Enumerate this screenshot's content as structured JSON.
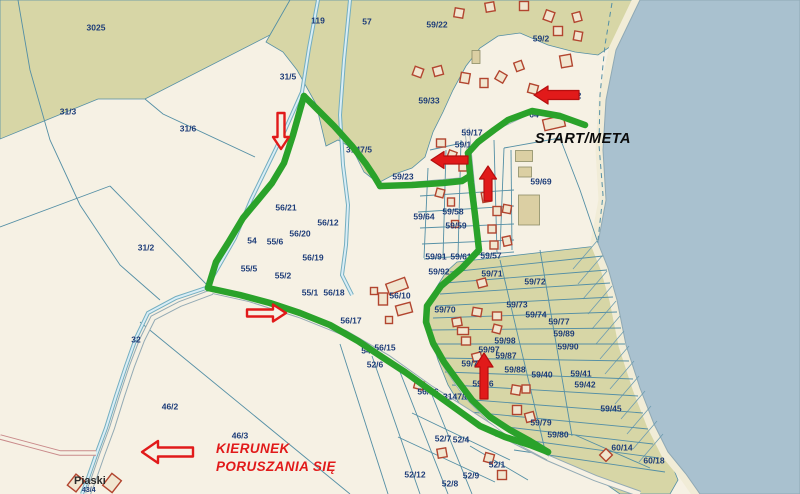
{
  "map": {
    "width": 800,
    "height": 494,
    "colors": {
      "land": "#f6f1e4",
      "forest": "#d7d6a6",
      "water": "#a9c1cf",
      "beach": "#f1ecd7",
      "boundary": "#548fa5",
      "route": "#2aa22a",
      "arrow": "#e11a1a",
      "arrow_dark": "#b50f0f",
      "label": "#1d3c78",
      "building_outline": "#b2452f",
      "building_fill": "#f1e6d0",
      "tan_fill": "#dbcfa3",
      "tan_outline": "#8c8c66",
      "road_edge": "#93aab4",
      "road_fill": "#f6f1e4",
      "stream_edge": "#74aebf",
      "stream_fill": "#d9edf6",
      "pink_road": "#c98a8a",
      "hatch": "#6d9cb0",
      "shore_edge": "#8fa9b5"
    },
    "texts": {
      "start_meta": "START/META",
      "kierunek_line1": "KIERUNEK",
      "kierunek_line2": "PORUSZANIA SIĘ",
      "place": "Piaski",
      "place_sub": "43/4"
    },
    "areas": [
      {
        "n": "forest-area-3025",
        "p": "0,0 290,0 270,35 145,99 98,99 0,139"
      },
      {
        "n": "forest-area-north",
        "p": "290,0 640,0 617,42 598,55 575,52 548,45 520,33 498,36 480,48 466,66 453,90 443,112 433,132 425,157 412,168 395,174 378,183 364,172 352,148 338,140 326,146 316,104 297,70 283,52 266,42"
      },
      {
        "n": "forest-area-southeast",
        "p": "457,262 597,246 608,268 617,300 626,345 640,388 654,424 668,455 678,480 670,494 620,494 600,480 560,462 530,447 505,436 480,425 462,408 448,385 438,360 430,335 428,308 436,288 446,272"
      }
    ],
    "beach": "640,0 616,50 606,100 603,150 606,200 598,243 608,268 617,300 626,345 640,388 654,424 668,452 686,474 700,494",
    "water": "640,0 800,0 800,494 700,494 686,474 668,452 654,424 640,388 626,345 617,300 608,268 598,243 606,200 603,150 606,100 616,50",
    "hatch_centers": [
      [
        585,
        255
      ],
      [
        590,
        270
      ],
      [
        595,
        285
      ],
      [
        600,
        300
      ],
      [
        604,
        315
      ],
      [
        608,
        330
      ],
      [
        612,
        345
      ],
      [
        617,
        360
      ],
      [
        622,
        375
      ],
      [
        627,
        390
      ],
      [
        633,
        405
      ],
      [
        639,
        420
      ],
      [
        645,
        435
      ],
      [
        651,
        448
      ]
    ],
    "streams": [
      {
        "p": "318,0 309,48 302,92 285,130 268,165 251,200 235,238 219,266 206,288 176,298 148,313 136,338 126,366 116,396 106,428 96,455 88,478 82,494"
      },
      {
        "p": "350,0 344,60 340,115 343,165 348,205 346,245 342,275 352,295"
      }
    ],
    "roads": [
      {
        "p": "205,289 250,299 300,315 345,333 388,358 430,388 468,412 505,436 548,458 595,478 640,494",
        "ow": 6.5,
        "iw": 4.5,
        "pink": false
      },
      {
        "p": "212,292 180,304 153,318 142,340 132,366 122,396 112,428 102,455 94,478 88,494",
        "ow": 6,
        "iw": 4,
        "pink": false
      },
      {
        "p": "96,453 60,453 30,445 0,437",
        "ow": 5.5,
        "iw": 3.5,
        "pink": true
      },
      {
        "p": "467,128 471,170 475,210 479,250 462,268 440,287 427,307 426,322 433,345 448,370 466,396 490,420 520,443 548,458",
        "ow": 5,
        "iw": 3.5,
        "pink": false
      },
      {
        "p": "378,187 468,179",
        "ow": 4.5,
        "iw": 3,
        "pink": false
      },
      {
        "p": "468,152 496,128 530,112 560,117 585,125",
        "ow": 4.5,
        "iw": 3,
        "pink": false
      }
    ],
    "lines": [
      {
        "p": "110,186 208,286"
      },
      {
        "p": "0,227 110,186"
      },
      {
        "p": "145,99 163,114 255,157"
      },
      {
        "p": "140,322 350,494"
      },
      {
        "p": "340,344 388,494"
      },
      {
        "p": "372,356 420,494"
      },
      {
        "p": "400,372 448,494"
      },
      {
        "p": "432,395 472,494"
      },
      {
        "p": "412,413 510,460"
      },
      {
        "p": "398,437 495,482"
      },
      {
        "p": "470,446 528,480"
      },
      {
        "p": "575,435 650,468"
      },
      {
        "p": "428,168 424,258"
      },
      {
        "p": "446,150 443,258"
      },
      {
        "p": "461,140 458,256"
      },
      {
        "p": "494,140 497,253"
      },
      {
        "p": "511,150 512,250"
      },
      {
        "p": "420,196 514,190"
      },
      {
        "p": "418,212 514,206"
      },
      {
        "p": "420,228 514,224"
      },
      {
        "p": "422,244 514,240"
      },
      {
        "p": "424,259 514,252"
      },
      {
        "p": "430,150 462,143"
      },
      {
        "p": "504,148 500,250"
      },
      {
        "p": "504,148 560,138"
      },
      {
        "p": "560,138 580,190 598,243"
      },
      {
        "p": "450,272 603,256"
      },
      {
        "p": "445,283 607,270"
      },
      {
        "p": "440,294 610,283"
      },
      {
        "p": "436,306 613,297"
      },
      {
        "p": "433,318 617,312"
      },
      {
        "p": "430,330 621,328"
      },
      {
        "p": "432,344 625,344"
      },
      {
        "p": "438,358 629,361"
      },
      {
        "p": "445,372 633,379"
      },
      {
        "p": "452,385 638,396"
      },
      {
        "p": "461,399 643,413"
      },
      {
        "p": "470,412 648,429"
      },
      {
        "p": "481,424 653,444"
      },
      {
        "p": "495,436 659,458"
      },
      {
        "p": "514,450 665,472"
      },
      {
        "p": "500,260 545,450"
      },
      {
        "p": "540,250 572,436"
      },
      {
        "p": "18,0 30,70 50,140 80,205 120,265 160,300"
      }
    ],
    "dashed": [
      {
        "p": "612,3 605,45 600,95 599,145 603,195 598,240"
      }
    ],
    "route_segments": [
      "585,125 560,116 532,111 508,120 494,130 478,142 468,153",
      "468,153 471,183 475,215 479,250 462,268 441,286 427,306 426,322 433,343 444,362 457,380 472,400 490,417 510,430 530,441 548,452",
      "548,452 530,445 505,437 480,426 455,408 430,390 405,372 382,357 358,341 330,325 300,313 270,303 240,295 208,288",
      "208,288 216,262 228,243 243,218 258,200 272,183 284,163 293,135 300,110 304,96",
      "304,96 318,110 334,126 352,146 366,164 374,176 380,186",
      "380,186 412,185 443,183 462,181 470,176"
    ],
    "arrows": [
      {
        "tx": 281,
        "ty": 113,
        "px": 281,
        "py": 149,
        "s": 3.5,
        "h": 8,
        "hl": 12,
        "style": "hollow"
      },
      {
        "tx": 468,
        "ty": 160,
        "px": 431,
        "py": 160,
        "s": 4,
        "h": 8.5,
        "hl": 13,
        "style": "solid"
      },
      {
        "tx": 488,
        "ty": 201,
        "px": 488,
        "py": 166,
        "s": 4,
        "h": 8.5,
        "hl": 13,
        "style": "solid"
      },
      {
        "tx": 247,
        "ty": 313,
        "px": 286,
        "py": 313,
        "s": 3.5,
        "h": 8.5,
        "hl": 13,
        "style": "hollow"
      },
      {
        "tx": 484,
        "ty": 399,
        "px": 484,
        "py": 353,
        "s": 4,
        "h": 9,
        "hl": 14,
        "style": "solid"
      },
      {
        "tx": 579,
        "ty": 95,
        "px": 534,
        "py": 95,
        "s": 4.5,
        "h": 9,
        "hl": 14,
        "style": "solid"
      },
      {
        "tx": 193,
        "ty": 452,
        "px": 142,
        "py": 452,
        "s": 4.5,
        "h": 11,
        "hl": 16,
        "style": "hollow"
      }
    ],
    "buildings": [
      [
        418,
        72,
        9,
        9,
        20,
        "o"
      ],
      [
        438,
        71,
        9,
        9,
        -15,
        "o"
      ],
      [
        465,
        78,
        9,
        10,
        10,
        "o"
      ],
      [
        484,
        83,
        8,
        9,
        0,
        "o"
      ],
      [
        501,
        77,
        9,
        9,
        30,
        "o"
      ],
      [
        519,
        66,
        8,
        9,
        -20,
        "o"
      ],
      [
        533,
        89,
        9,
        9,
        15,
        "o"
      ],
      [
        459,
        13,
        9,
        9,
        10,
        "o"
      ],
      [
        490,
        7,
        9,
        9,
        -10,
        "o"
      ],
      [
        524,
        6,
        9,
        9,
        0,
        "o"
      ],
      [
        549,
        16,
        9,
        10,
        20,
        "o"
      ],
      [
        577,
        17,
        8,
        9,
        -15,
        "o"
      ],
      [
        558,
        31,
        9,
        9,
        0,
        "o"
      ],
      [
        578,
        36,
        8,
        9,
        10,
        "o"
      ],
      [
        566,
        61,
        11,
        12,
        -10,
        "o"
      ],
      [
        554,
        123,
        21,
        11,
        -13,
        "o"
      ],
      [
        476,
        57,
        8,
        13,
        0,
        "t"
      ],
      [
        440,
        193,
        8,
        8,
        15,
        "o"
      ],
      [
        451,
        202,
        7,
        8,
        0,
        "o"
      ],
      [
        486,
        197,
        8,
        10,
        -10,
        "o"
      ],
      [
        497,
        211,
        8,
        9,
        0,
        "o"
      ],
      [
        507,
        209,
        8,
        8,
        10,
        "o"
      ],
      [
        492,
        229,
        8,
        8,
        0,
        "o"
      ],
      [
        507,
        241,
        8,
        9,
        -12,
        "o"
      ],
      [
        494,
        245,
        8,
        8,
        0,
        "o"
      ],
      [
        452,
        155,
        8,
        8,
        20,
        "o"
      ],
      [
        441,
        143,
        9,
        8,
        0,
        "o"
      ],
      [
        463,
        167,
        8,
        8,
        0,
        "o"
      ],
      [
        455,
        224,
        7,
        7,
        0,
        "o"
      ],
      [
        524,
        156,
        17,
        11,
        0,
        "t"
      ],
      [
        525,
        172,
        13,
        10,
        0,
        "t"
      ],
      [
        529,
        210,
        21,
        30,
        0,
        "t"
      ],
      [
        397,
        286,
        20,
        11,
        -20,
        "o"
      ],
      [
        383,
        299,
        9,
        12,
        0,
        "o"
      ],
      [
        404,
        309,
        15,
        10,
        -15,
        "o"
      ],
      [
        389,
        320,
        7,
        7,
        0,
        "o"
      ],
      [
        374,
        291,
        7,
        7,
        0,
        "o"
      ],
      [
        482,
        283,
        9,
        8,
        -15,
        "o"
      ],
      [
        477,
        312,
        9,
        8,
        10,
        "o"
      ],
      [
        497,
        316,
        9,
        8,
        0,
        "o"
      ],
      [
        457,
        322,
        9,
        8,
        -10,
        "o"
      ],
      [
        463,
        331,
        11,
        7,
        0,
        "o"
      ],
      [
        497,
        329,
        8,
        8,
        15,
        "o"
      ],
      [
        466,
        341,
        9,
        8,
        0,
        "o"
      ],
      [
        477,
        357,
        9,
        8,
        -15,
        "o"
      ],
      [
        516,
        390,
        9,
        9,
        10,
        "o"
      ],
      [
        517,
        410,
        9,
        9,
        0,
        "o"
      ],
      [
        530,
        417,
        9,
        9,
        -15,
        "o"
      ],
      [
        526,
        389,
        8,
        8,
        0,
        "o"
      ],
      [
        419,
        385,
        9,
        8,
        15,
        "o"
      ],
      [
        442,
        453,
        9,
        9,
        -10,
        "o"
      ],
      [
        489,
        458,
        9,
        9,
        15,
        "o"
      ],
      [
        502,
        475,
        9,
        9,
        0,
        "o"
      ],
      [
        606,
        455,
        9,
        9,
        45,
        "o"
      ],
      [
        76,
        483,
        11,
        14,
        38,
        "o"
      ],
      [
        112,
        483,
        12,
        15,
        38,
        "o"
      ]
    ],
    "labels": [
      [
        "3025",
        96,
        28
      ],
      [
        "31/3",
        68,
        112
      ],
      [
        "119",
        318,
        21
      ],
      [
        "57",
        367,
        22
      ],
      [
        "59/22",
        437,
        25
      ],
      [
        "59/2",
        541,
        39
      ],
      [
        "31/5",
        288,
        77
      ],
      [
        "31/6",
        188,
        129
      ],
      [
        "59/33",
        429,
        101
      ],
      [
        "2",
        579,
        96
      ],
      [
        "64",
        534,
        115
      ],
      [
        "59/17",
        472,
        133
      ],
      [
        "59/1",
        463,
        145
      ],
      [
        "3147/5",
        359,
        150
      ],
      [
        "59/23",
        403,
        177
      ],
      [
        "59/69",
        541,
        182
      ],
      [
        "56/21",
        286,
        208
      ],
      [
        "59/58",
        453,
        212
      ],
      [
        "59/64",
        424,
        217
      ],
      [
        "56/12",
        328,
        223
      ],
      [
        "59/59",
        456,
        226
      ],
      [
        "56/20",
        300,
        234
      ],
      [
        "55/6",
        275,
        242
      ],
      [
        "54",
        252,
        241
      ],
      [
        "31/2",
        146,
        248
      ],
      [
        "56/19",
        313,
        258
      ],
      [
        "59/91",
        436,
        257
      ],
      [
        "59/61",
        461,
        257
      ],
      [
        "59/57",
        491,
        256
      ],
      [
        "55/5",
        249,
        269
      ],
      [
        "59/92",
        439,
        272
      ],
      [
        "55/2",
        283,
        276
      ],
      [
        "59/71",
        492,
        274
      ],
      [
        "59/72",
        535,
        282
      ],
      [
        "55/1",
        310,
        293
      ],
      [
        "56/18",
        334,
        293
      ],
      [
        "56/10",
        400,
        296
      ],
      [
        "59/70",
        445,
        310
      ],
      [
        "59/73",
        517,
        305
      ],
      [
        "59/74",
        536,
        315
      ],
      [
        "56/17",
        351,
        321
      ],
      [
        "59/77",
        559,
        322
      ],
      [
        "59/89",
        564,
        334
      ],
      [
        "59/90",
        568,
        347
      ],
      [
        "32",
        136,
        340
      ],
      [
        "59/98",
        505,
        341
      ],
      [
        "56/15",
        385,
        348
      ],
      [
        "54",
        366,
        351
      ],
      [
        "59/97",
        489,
        350
      ],
      [
        "59/87",
        506,
        356
      ],
      [
        "52/6",
        375,
        365
      ],
      [
        "59/75",
        472,
        364
      ],
      [
        "59/88",
        515,
        370
      ],
      [
        "59/40",
        542,
        375
      ],
      [
        "59/41",
        581,
        374
      ],
      [
        "59/42",
        585,
        385
      ],
      [
        "59/76",
        483,
        384
      ],
      [
        "56/16",
        428,
        392
      ],
      [
        "3147/6",
        456,
        397
      ],
      [
        "46/2",
        170,
        407
      ],
      [
        "59/45",
        611,
        409
      ],
      [
        "59/79",
        541,
        423
      ],
      [
        "46/3",
        240,
        436
      ],
      [
        "59/80",
        558,
        435
      ],
      [
        "52/7",
        443,
        439
      ],
      [
        "52/4",
        461,
        440
      ],
      [
        "60/14",
        622,
        448
      ],
      [
        "52/1",
        497,
        465
      ],
      [
        "60/18",
        654,
        461
      ],
      [
        "52/12",
        415,
        475
      ],
      [
        "52/9",
        471,
        476
      ],
      [
        "52/8",
        450,
        484
      ]
    ]
  }
}
